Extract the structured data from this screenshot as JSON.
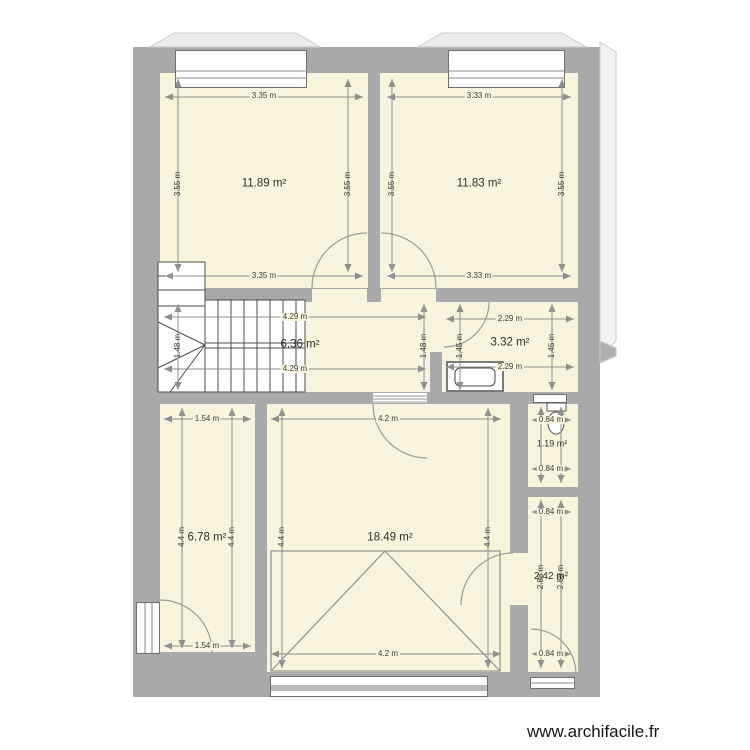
{
  "watermark": "www.archifacile.fr",
  "colors": {
    "wall": "#a9a9a9",
    "room": "#f7f3dc",
    "dimline": "#8f8f8f",
    "stair": "#4d4d4d"
  },
  "rooms": {
    "top_left": {
      "area": "11.89 m²",
      "top": "3.35 m",
      "bottom": "3.35 m",
      "left": "3.55 m",
      "right": "3.55 m"
    },
    "top_right": {
      "area": "11.83 m²",
      "top": "3.33 m",
      "bottom": "3.33 m",
      "left": "3.55 m",
      "right": "3.55 m"
    },
    "corridor": {
      "area": "6.36 m²",
      "top": "4.29 m",
      "bottom": "4.29 m",
      "left": "1.48 m",
      "right": "1.48 m"
    },
    "bathroom": {
      "area": "3.32 m²",
      "top": "2.29 m",
      "bottom": "2.29 m",
      "left": "1.45 m",
      "right": "1.45 m"
    },
    "lower_left": {
      "area": "6.78 m²",
      "top": "1.54 m",
      "bottom": "1.54 m",
      "left": "4.4 m",
      "right": "4.4 m"
    },
    "garage": {
      "area": "18.49 m²",
      "top": "4.2 m",
      "bottom": "4.2 m",
      "left": "4.4 m",
      "right": "4.4 m"
    },
    "wc": {
      "area": "1.19 m²",
      "top": "0.84 m",
      "bottom": "0.84 m"
    },
    "lower_right": {
      "area": "2.42 m²",
      "top": "0.84 m",
      "bottom": "0.84 m",
      "left": "2.88 m",
      "right": "2.88 m"
    }
  }
}
